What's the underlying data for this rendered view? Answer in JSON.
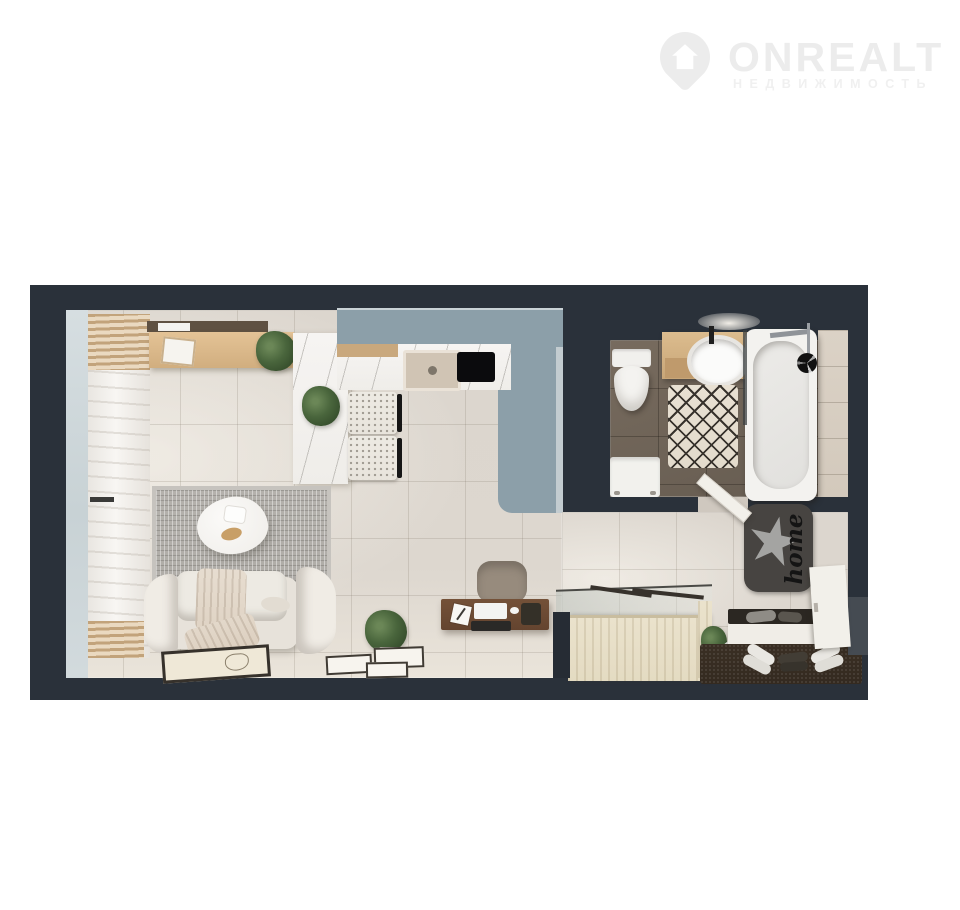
{
  "watermark": {
    "brand": "ONREALT",
    "tagline": "НЕДВИЖИМОСТЬ",
    "icon": "location-pin-house-icon",
    "text_color": "#ececec"
  },
  "floor_plan": {
    "view": "3d-top-down-apartment-render",
    "home_mat_text": "home",
    "colors": {
      "wall": "#2a313a",
      "kitchen_accent_blue": "#8c9fa9",
      "floor_living": "#ddd7cf",
      "floor_bathroom": "#6e6357",
      "floor_hallway": "#d9d3cb",
      "window": "#ccd5d8",
      "wood_light": "#d7b284",
      "marble": "#f4f2f0",
      "desk_wood": "#6a4a34",
      "wardrobe_wood": "#e8e0c9",
      "entry_mat_brown": "#382d23",
      "home_mat_dark": "#474441"
    },
    "rooms": [
      "living-room-with-kitchen",
      "bathroom",
      "hallway"
    ],
    "furniture_visible": [
      "window",
      "curtains",
      "tv-sideboard",
      "wall-shelf",
      "kitchen-island",
      "kitchen-counter",
      "sink",
      "cooktop",
      "bar-chairs",
      "rug",
      "coffee-table",
      "sofa",
      "throw-blanket",
      "floor-picture",
      "plants",
      "desk",
      "desk-chair",
      "laptop",
      "monitor",
      "toilet",
      "vanity-sink",
      "bath-rug",
      "washing-machine",
      "bathtub",
      "shower",
      "glass-partition",
      "wardrobe",
      "home-mat",
      "shoe-bench",
      "entry-mat",
      "shoes",
      "floor-mirror",
      "doors"
    ]
  }
}
